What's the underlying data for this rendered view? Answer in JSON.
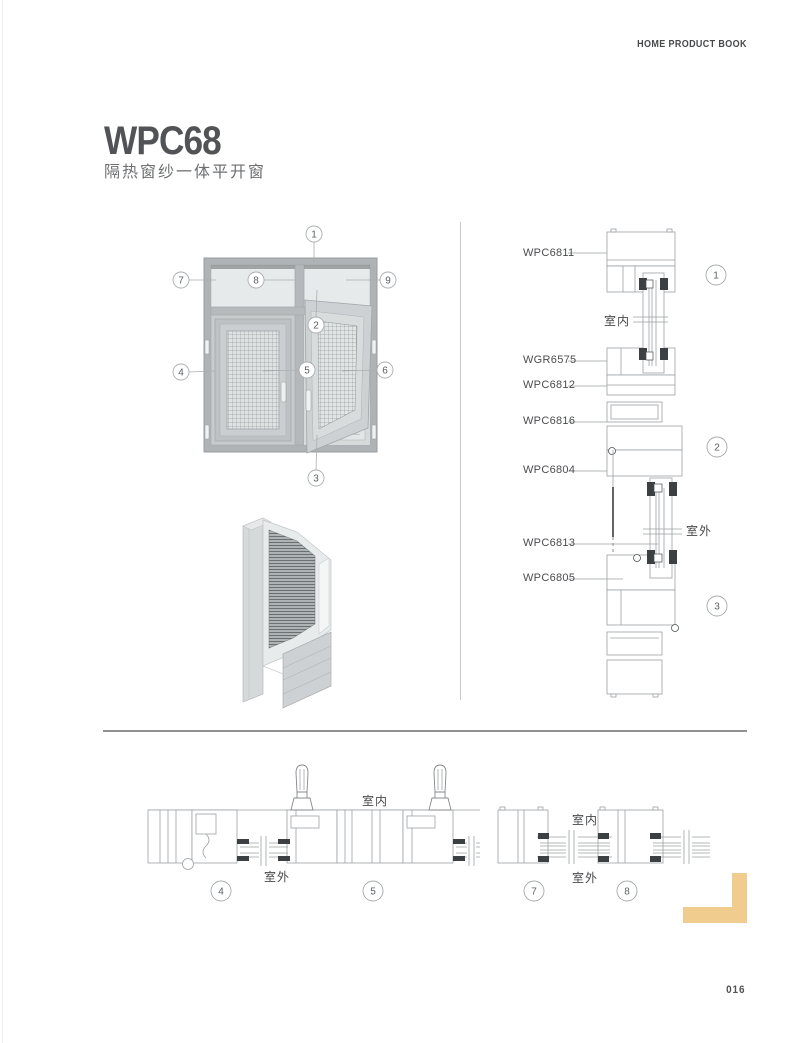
{
  "header": {
    "book_title": "HOME PRODUCT BOOK"
  },
  "product": {
    "model": "WPC68",
    "subtitle": "隔热窗纱一体平开窗"
  },
  "overview_diagram": {
    "callouts": [
      "1",
      "2",
      "3",
      "4",
      "5",
      "6",
      "7",
      "8",
      "9"
    ]
  },
  "vertical_section": {
    "part_labels": [
      "WPC6811",
      "WGR6575",
      "WPC6812",
      "WPC6816",
      "WPC6804",
      "WPC6813",
      "WPC6805"
    ],
    "indoor_label": "室内",
    "outdoor_label": "室外",
    "callouts": [
      "1",
      "2",
      "3"
    ]
  },
  "horizontal_section_left": {
    "indoor_label": "室内",
    "outdoor_label": "室外",
    "callouts": [
      "4",
      "5"
    ]
  },
  "horizontal_section_right": {
    "indoor_label": "室内",
    "outdoor_label": "室外",
    "callouts": [
      "7",
      "8"
    ]
  },
  "footer": {
    "page_number": "016"
  },
  "colors": {
    "accent_gold": "#F0CD8E",
    "drawing_line": "#9BA0A3",
    "frame_gray": "#B3B7B9",
    "text_dark": "#4B4C4E"
  }
}
